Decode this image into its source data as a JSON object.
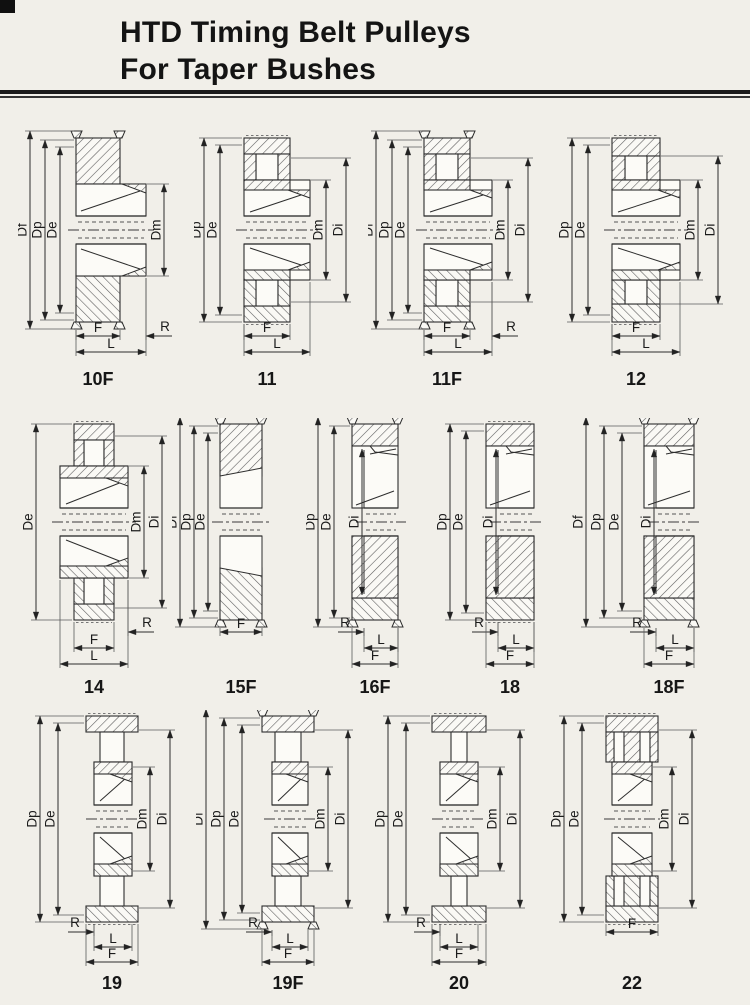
{
  "page": {
    "title_line1": "HTD Timing Belt Pulleys",
    "title_line2": "For Taper Bushes"
  },
  "figures": [
    {
      "label": "10F",
      "variant": "flanged solid rim, hub extended right",
      "left_dims": [
        "Df",
        "Dp",
        "De"
      ],
      "right_dims": [
        "Dm"
      ],
      "inner_dims": [],
      "bottom_dims": [
        "F",
        "R",
        "L"
      ]
    },
    {
      "label": "11",
      "variant": "plain rim with pocket, hub extended right",
      "left_dims": [
        "Dp",
        "De"
      ],
      "right_dims": [
        "Dm",
        "Di"
      ],
      "inner_dims": [],
      "bottom_dims": [
        "F",
        "L"
      ]
    },
    {
      "label": "11F",
      "variant": "flanged rim with pocket, hub extended right",
      "left_dims": [
        "Df",
        "Dp",
        "De"
      ],
      "right_dims": [
        "Dm",
        "Di"
      ],
      "inner_dims": [],
      "bottom_dims": [
        "F",
        "R",
        "L"
      ]
    },
    {
      "label": "12",
      "variant": "plain rim with pocket, hub extended right",
      "left_dims": [
        "Dp",
        "De"
      ],
      "right_dims": [
        "Dm",
        "Di"
      ],
      "inner_dims": [],
      "bottom_dims": [
        "F",
        "L"
      ]
    },
    {
      "label": "14",
      "variant": "plain rim with pocket, wide central hub",
      "left_dims": [
        "De"
      ],
      "right_dims": [
        "Dm",
        "Di"
      ],
      "inner_dims": [],
      "bottom_dims": [
        "R",
        "F",
        "L"
      ]
    },
    {
      "label": "15F",
      "variant": "flanged solid disc",
      "left_dims": [
        "Df",
        "Dp",
        "De"
      ],
      "right_dims": [],
      "inner_dims": [],
      "bottom_dims": [
        "F"
      ]
    },
    {
      "label": "16F",
      "variant": "flanged web disc, recessed bush",
      "left_dims": [
        "Dp",
        "De"
      ],
      "right_dims": [],
      "inner_dims": [
        "Di"
      ],
      "bottom_dims": [
        "R",
        "L",
        "F"
      ]
    },
    {
      "label": "18",
      "variant": "plain web disc, recessed bush",
      "left_dims": [
        "Dp",
        "De"
      ],
      "right_dims": [],
      "inner_dims": [
        "Di"
      ],
      "bottom_dims": [
        "R",
        "L",
        "F"
      ]
    },
    {
      "label": "18F",
      "variant": "flanged web disc, recessed bush",
      "left_dims": [
        "Df",
        "Dp",
        "De"
      ],
      "right_dims": [],
      "inner_dims": [
        "Di"
      ],
      "bottom_dims": [
        "R",
        "L",
        "F"
      ]
    },
    {
      "label": "19",
      "variant": "plain rim with web stem, central hub",
      "left_dims": [
        "Dp",
        "De"
      ],
      "right_dims": [
        "Dm",
        "Di"
      ],
      "inner_dims": [],
      "bottom_dims": [
        "R",
        "L",
        "F"
      ]
    },
    {
      "label": "19F",
      "variant": "flanged rim with web stem, central hub",
      "left_dims": [
        "Df",
        "Dp",
        "De"
      ],
      "right_dims": [
        "Dm",
        "Di"
      ],
      "inner_dims": [],
      "bottom_dims": [
        "R",
        "L",
        "F"
      ]
    },
    {
      "label": "20",
      "variant": "plain rim with narrow web stem, central hub",
      "left_dims": [
        "Dp",
        "De"
      ],
      "right_dims": [
        "Dm",
        "Di"
      ],
      "inner_dims": [],
      "bottom_dims": [
        "R",
        "L",
        "F"
      ]
    },
    {
      "label": "22",
      "variant": "plain rim with pockets and stem, central hub",
      "left_dims": [
        "Dp",
        "De"
      ],
      "right_dims": [
        "Dm",
        "Di"
      ],
      "inner_dims": [],
      "bottom_dims": [
        "F"
      ]
    }
  ]
}
